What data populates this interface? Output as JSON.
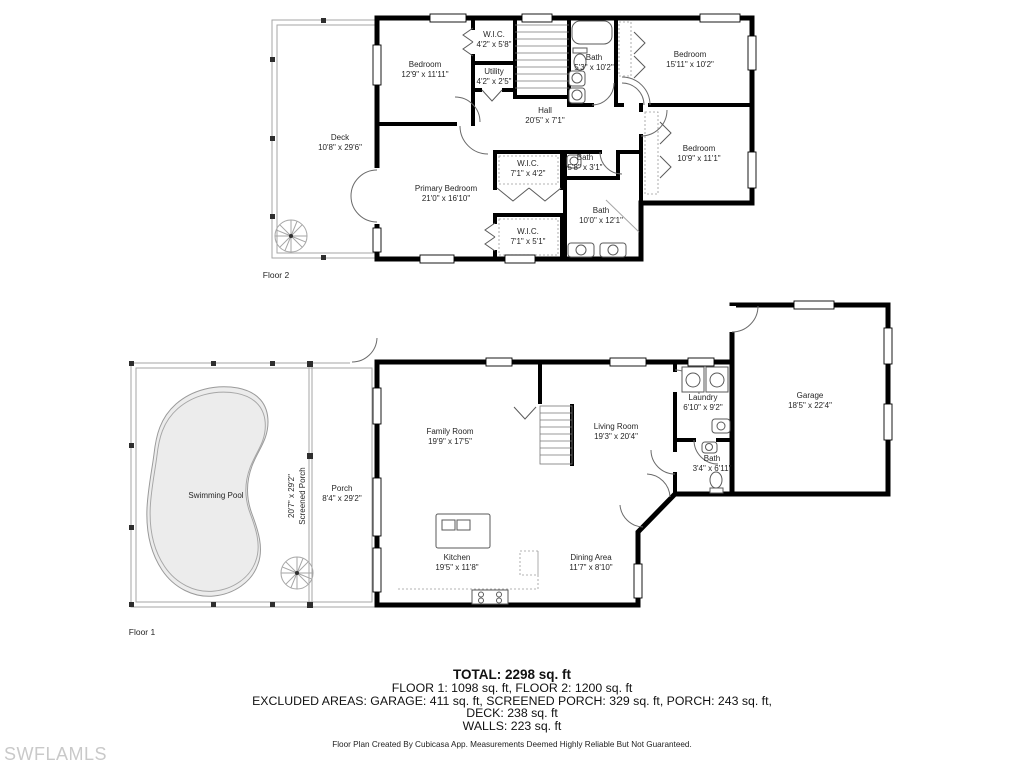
{
  "watermark": "SWFLAMLS",
  "footer": "Floor Plan Created By Cubicasa App. Measurements Deemed Highly Reliable But Not Guaranteed.",
  "summary": {
    "total": "TOTAL: 2298 sq. ft",
    "floors": "FLOOR 1: 1098 sq. ft, FLOOR 2: 1200 sq. ft",
    "excluded": "EXCLUDED AREAS: GARAGE: 411 sq. ft, SCREENED PORCH: 329 sq. ft, PORCH: 243 sq. ft,",
    "deck": "DECK: 238 sq. ft",
    "walls": "WALLS: 223 sq. ft"
  },
  "colors": {
    "wall": "#000000",
    "pool_fill": "#ececec",
    "watermark_gray": "#c9c9c9"
  },
  "floor2": {
    "label": "Floor 2",
    "rooms": [
      {
        "name": "Bedroom",
        "dims": "12'9\" x 11'11\""
      },
      {
        "name": "W.I.C.",
        "dims": "4'2\" x 5'8\""
      },
      {
        "name": "Utility",
        "dims": "4'2\" x 2'5\""
      },
      {
        "name": "Bath",
        "dims": "5'3\" x 10'2\""
      },
      {
        "name": "Bedroom",
        "dims": "15'11\" x 10'2\""
      },
      {
        "name": "Hall",
        "dims": "20'5\" x 7'1\""
      },
      {
        "name": "Deck",
        "dims": "10'8\" x 29'6\""
      },
      {
        "name": "Bedroom",
        "dims": "10'9\" x 11'1\""
      },
      {
        "name": "Bath",
        "dims": "5'8\" x 3'1\""
      },
      {
        "name": "Primary Bedroom",
        "dims": "21'0\" x 16'10\""
      },
      {
        "name": "W.I.C.",
        "dims": "7'1\" x 4'2\""
      },
      {
        "name": "Bath",
        "dims": "10'0\" x 12'1\""
      },
      {
        "name": "W.I.C.",
        "dims": "7'1\" x 5'1\""
      }
    ]
  },
  "floor1": {
    "label": "Floor 1",
    "rooms": [
      {
        "name": "Swimming Pool",
        "dims": ""
      },
      {
        "name": "Screened Porch",
        "dims": "20'7\" x 29'2\""
      },
      {
        "name": "Porch",
        "dims": "8'4\" x 29'2\""
      },
      {
        "name": "Family Room",
        "dims": "19'9\" x 17'5\""
      },
      {
        "name": "Living Room",
        "dims": "19'3\" x 20'4\""
      },
      {
        "name": "Laundry",
        "dims": "6'10\" x 9'2\""
      },
      {
        "name": "Garage",
        "dims": "18'5\" x 22'4\""
      },
      {
        "name": "Bath",
        "dims": "3'4\" x 6'11\""
      },
      {
        "name": "Kitchen",
        "dims": "19'5\" x 11'8\""
      },
      {
        "name": "Dining Area",
        "dims": "11'7\" x 8'10\""
      }
    ]
  }
}
